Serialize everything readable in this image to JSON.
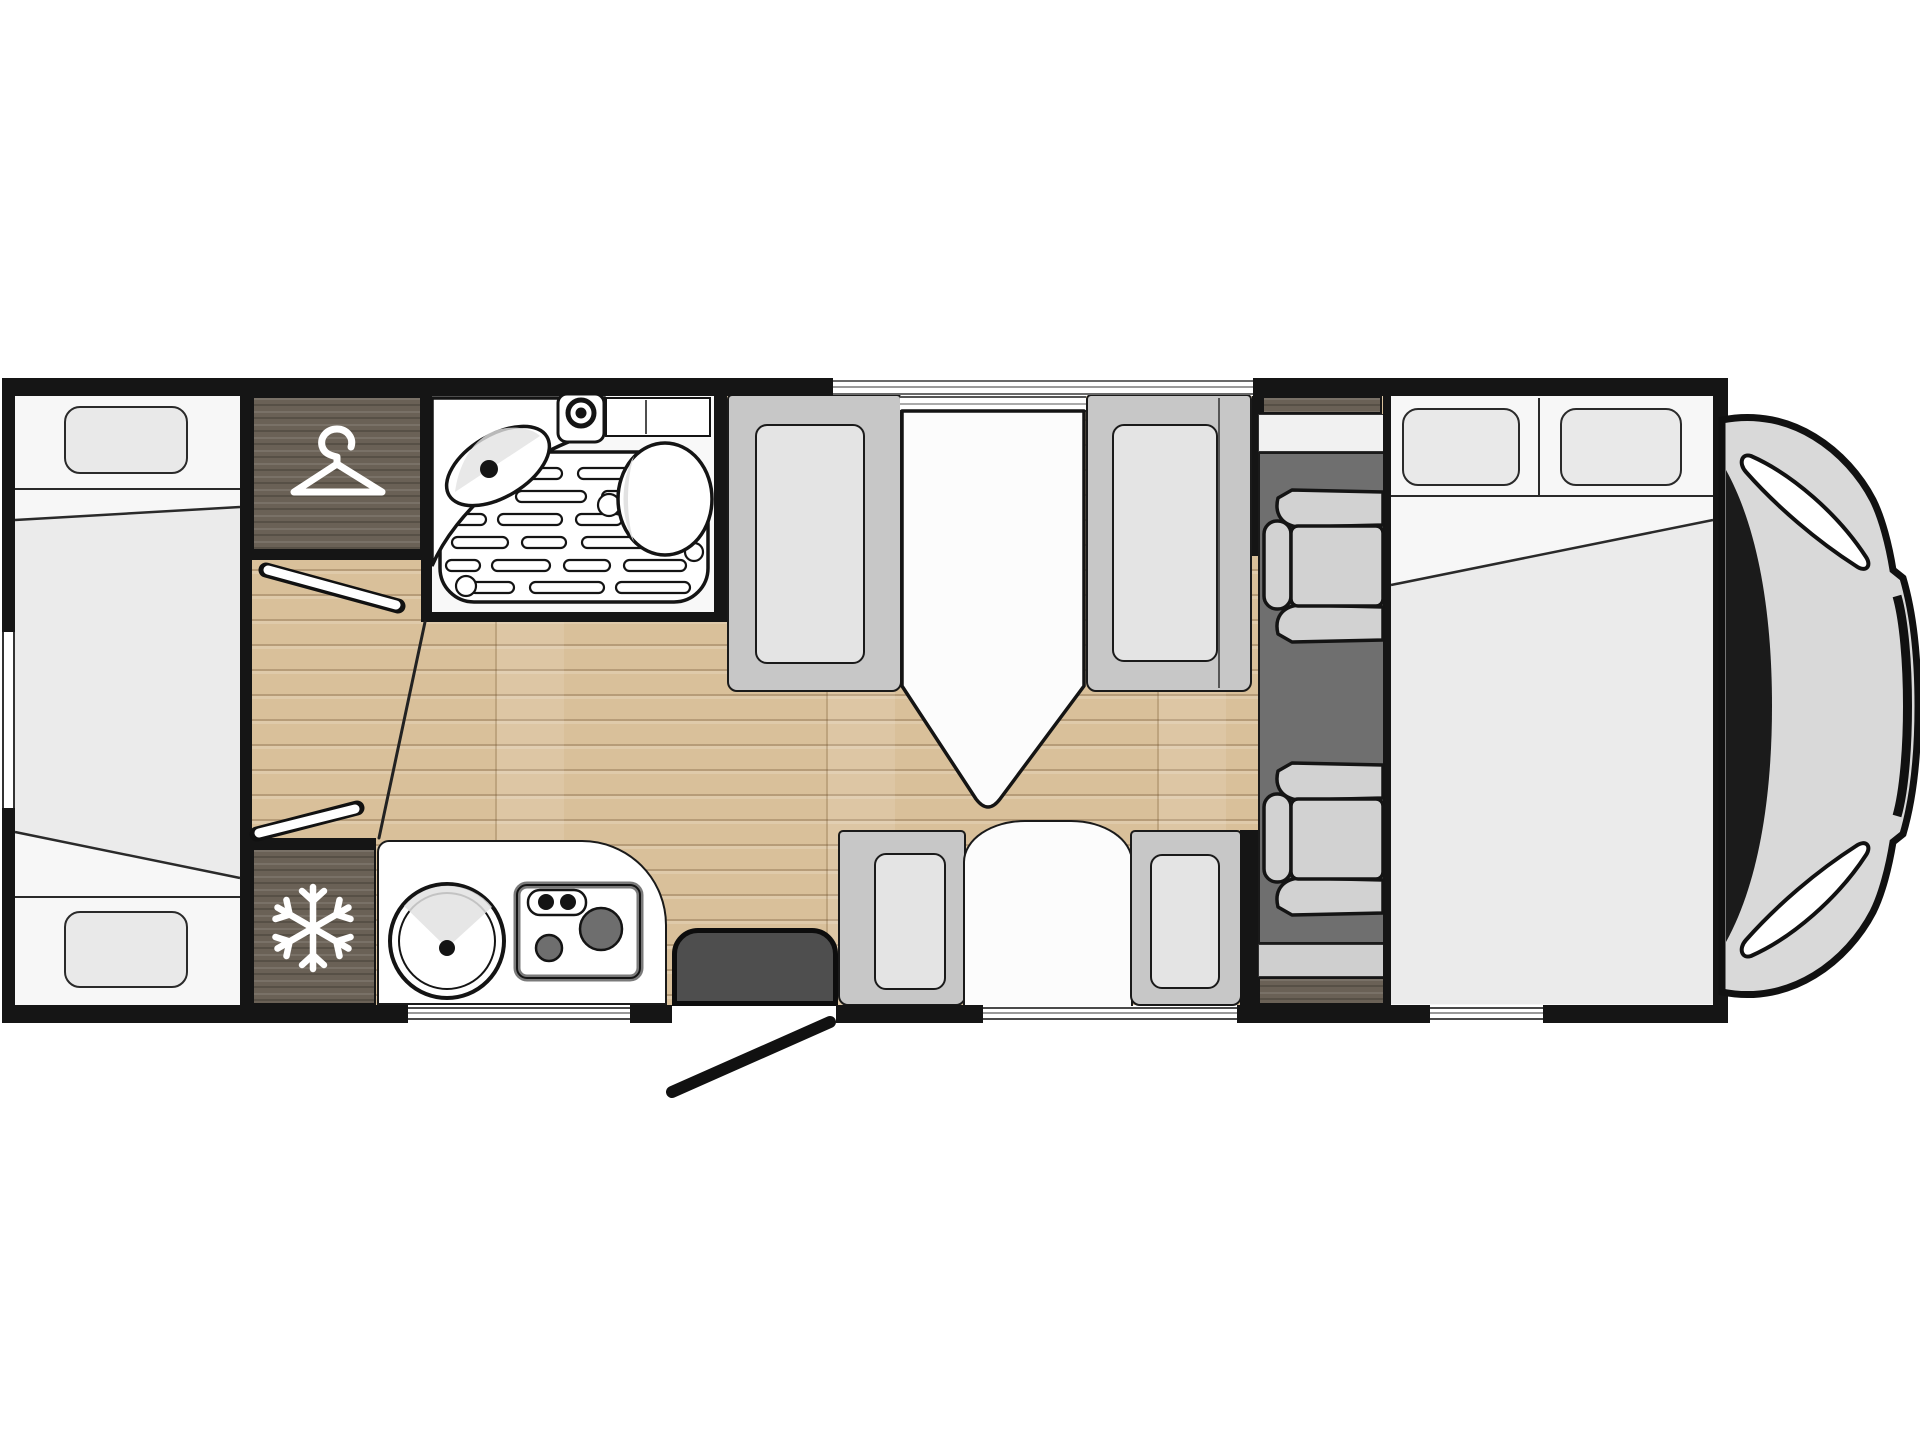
{
  "page": {
    "background": "#ffffff",
    "content_type": "motorhome-floorplan-top-view"
  },
  "colors": {
    "page": "#ffffff",
    "wall": "#151515",
    "outline": "#1a1a1a",
    "floor": "#d9c09a",
    "darkwood": "#6a6156",
    "white": "#f8f8f8",
    "bed": "#f7f7f7",
    "duvet": "#ebebeb",
    "pillow": "#e9e9e9",
    "seat": "#c7c7c7",
    "cushion": "#e4e4e4",
    "cab_floor": "#6f6f6f",
    "cab_step": "#cfcfcf",
    "cab_seat": "#d2d2d2",
    "step": "#4e4e4e",
    "table": "#fcfcfc",
    "fixture_white": "#ffffff",
    "fixture_shade": "#e2e2e2",
    "hob_border": "#7a7a7a",
    "burner": "#6e6e6e",
    "nose": "#d9d9d9",
    "windshield": "#1b1b1b",
    "glassline": "#9a9a9a",
    "icon_white": "#ffffff"
  },
  "icons": {
    "wardrobe": {
      "name": "hanger-icon",
      "meaning": "clothes wardrobe"
    },
    "fridge": {
      "name": "snowflake-icon",
      "meaning": "refrigerator"
    }
  },
  "legend": {
    "rear_bed": "rear bed with two pillows",
    "wardrobe": "wardrobe cabinet",
    "bathroom": "washroom with basin, shower tray and toilet",
    "fridge": "refrigerator cabinet",
    "kitchen": "kitchen block with round sink and two-burner hob",
    "entry": "entrance step and open entry door",
    "dinette_front": "face-to-face dinette seats with pedestal table",
    "dinette_rear": "two seats with half table",
    "cab": "cab floor with two captain seats",
    "front_bed": "front double bed with two pillows",
    "vehicle_nose": "van cab nose with windshield"
  }
}
